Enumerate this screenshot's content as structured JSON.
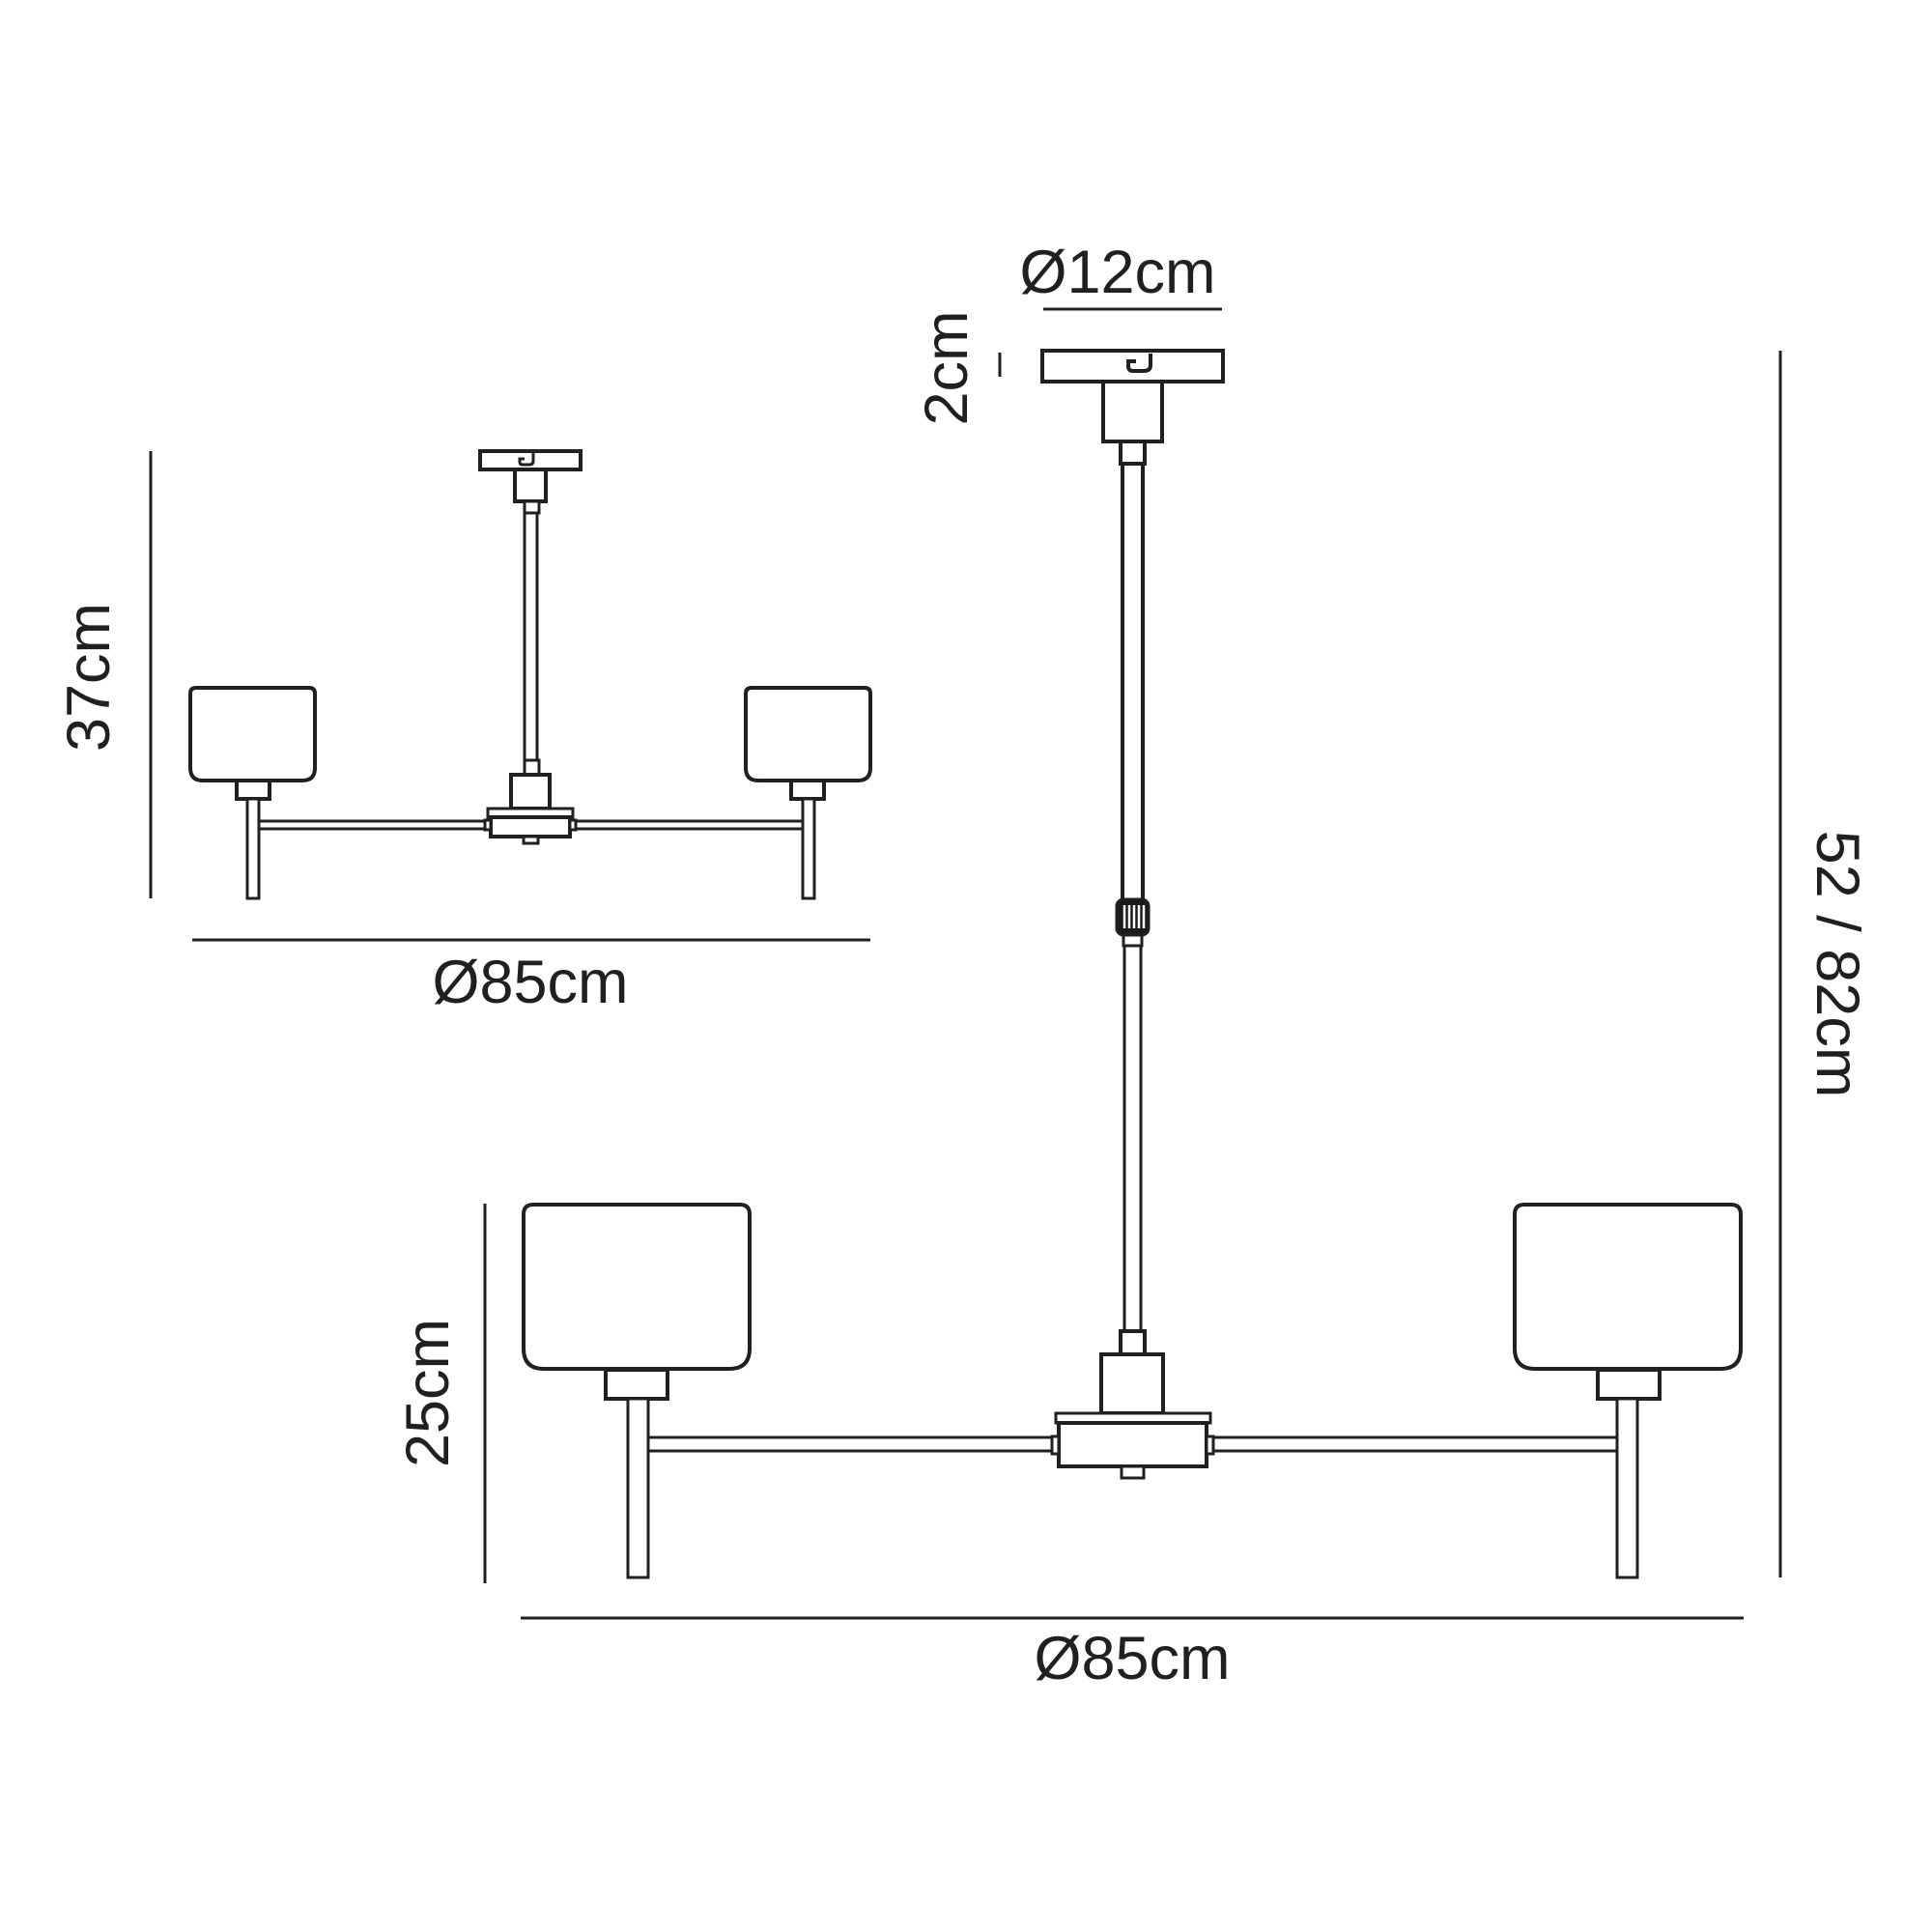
{
  "diagram": {
    "colors": {
      "line": "#231f20",
      "background": "#ffffff",
      "knob_fill": "#1a1a1a"
    },
    "views": {
      "semi_flush": {
        "height": "37cm",
        "diameter": "Ø85cm"
      },
      "pendant": {
        "canopy_diameter": "Ø12cm",
        "canopy_height": "2cm",
        "drop_height": "52 / 82cm",
        "shade_assembly_height": "25cm",
        "diameter": "Ø85cm"
      }
    }
  }
}
